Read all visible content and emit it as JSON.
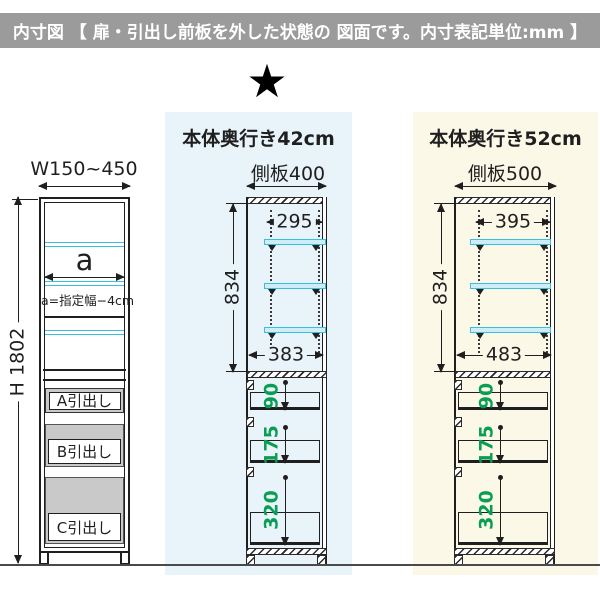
{
  "header": {
    "title": "内寸図 【 扉・引出し前板を外した状態の 図面です。内寸表記単位:mm 】"
  },
  "star_icon": "★",
  "front_view": {
    "width_label": "W150~450",
    "height_label": "H 1802",
    "shelf_var_label": "a",
    "shelf_note": "a=指定幅−4cm",
    "drawers": {
      "a": "A引出し",
      "b": "B引出し",
      "c": "C引出し"
    }
  },
  "depth42": {
    "title": "本体奥行き42cm",
    "panel_label": "側板400",
    "inner_top_width": "295",
    "inner_height": "834",
    "inner_bottom_width": "383",
    "drawer_depths": {
      "a": "90",
      "b": "175",
      "c": "320"
    }
  },
  "depth52": {
    "title": "本体奥行き52cm",
    "panel_label": "側板500",
    "inner_top_width": "395",
    "inner_height": "834",
    "inner_bottom_width": "483",
    "drawer_depths": {
      "a": "90",
      "b": "175",
      "c": "320"
    }
  },
  "colors": {
    "header_gray": "#9b9b9b",
    "blue_bg": "#e9f3fa",
    "cream_bg": "#fcf8e7",
    "shelf_cyan": "#3bbfdc",
    "dim_green": "#0a9e55"
  }
}
